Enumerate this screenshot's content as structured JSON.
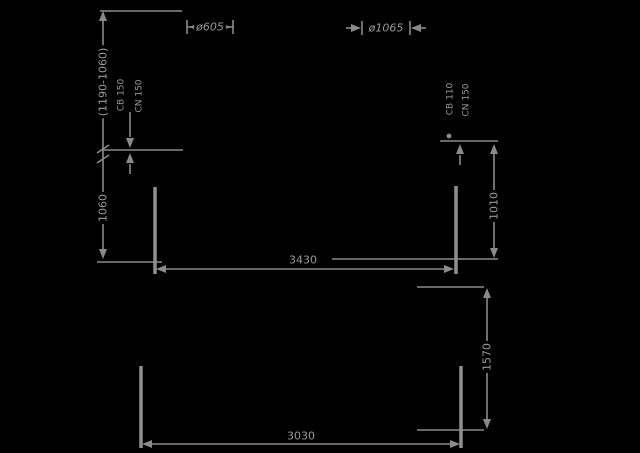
{
  "drawing": {
    "type": "technical-dimension-drawing",
    "background_color": "#000000",
    "line_color": "#8a8a8a",
    "text_color": "#9a9a9a",
    "dimensions": {
      "top_left_vertical_range": "(1190-1060)",
      "left_vertical_height": "1060",
      "right_vertical_height": "1010",
      "lower_right_vertical_height": "1570",
      "upper_span": "3430",
      "lower_span": "3030",
      "small_diameter": "ø605",
      "large_diameter": "ø1065",
      "left_hook_labels": [
        "CB 150",
        "CN 150"
      ],
      "right_hook_labels": [
        "CB 110",
        "CN 150"
      ]
    }
  }
}
